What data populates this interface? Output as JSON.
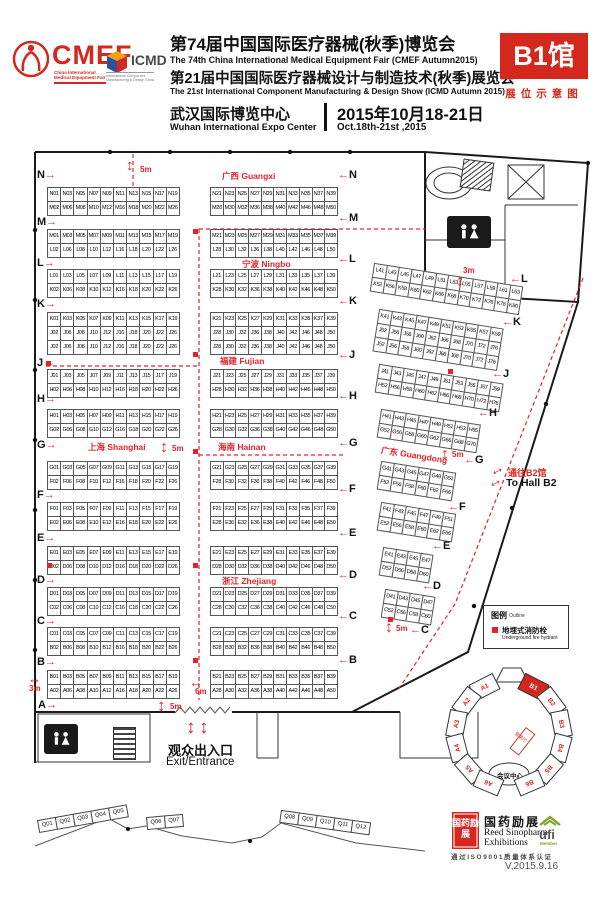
{
  "colors": {
    "brand_red": "#d4281f",
    "map_red": "#e62129",
    "ufi_green": "#7ba428"
  },
  "header": {
    "cmef_word": "CMEF",
    "cmef_sub1": "China International",
    "cmef_sub2": "Medical Equipment Fair",
    "icmd_word": "ICMD",
    "icmd_sub1": "International Component",
    "icmd_sub2": "Manufacturing & Design Show",
    "title_cn_1": "第74届中国国际医疗器械(秋季)博览会",
    "title_en_1": "The 74th China International Medical Equipment Fair (CMEF Autumn2015)",
    "title_cn_2": "第21届中国国际医疗器械设计与制造技术(秋季)展览会",
    "title_en_2": "The 21st International Component Manufacturing & Design Show (ICMD Autumn 2015)",
    "venue_cn": "武汉国际博览中心",
    "venue_en": "Wuhan International Expo Center",
    "date_cn": "2015年10月18-21日",
    "date_en": "Oct.18th-21st ,2015",
    "hall_badge": "B1馆",
    "badge_sub": "展位示意图"
  },
  "map": {
    "region_labels": [
      {
        "text": "广西 Guangxi",
        "x": 222,
        "y": 170
      },
      {
        "text": "宁波 Ningbo",
        "x": 242,
        "y": 258
      },
      {
        "text": "福建 Fujian",
        "x": 220,
        "y": 355
      },
      {
        "text": "上海 Shanghai",
        "x": 88,
        "y": 441
      },
      {
        "text": "海南 Hainan",
        "x": 218,
        "y": 441
      },
      {
        "text": "浙江 Zhejiang",
        "x": 222,
        "y": 575
      },
      {
        "text": "广东 Guangdong",
        "x": 382,
        "y": 444,
        "rot": 9
      }
    ],
    "row_letters": [
      {
        "t": "N",
        "x": 37,
        "y": 170,
        "d": "r"
      },
      {
        "t": "M",
        "x": 37,
        "y": 217,
        "d": "r"
      },
      {
        "t": "L",
        "x": 37,
        "y": 258,
        "d": "r"
      },
      {
        "t": "K",
        "x": 37,
        "y": 299,
        "d": "r"
      },
      {
        "t": "J",
        "x": 37,
        "y": 358,
        "d": "r"
      },
      {
        "t": "H",
        "x": 37,
        "y": 394,
        "d": "r"
      },
      {
        "t": "G",
        "x": 37,
        "y": 440,
        "d": "r"
      },
      {
        "t": "F",
        "x": 37,
        "y": 490,
        "d": "r"
      },
      {
        "t": "E",
        "x": 37,
        "y": 533,
        "d": "r"
      },
      {
        "t": "D",
        "x": 37,
        "y": 575,
        "d": "r"
      },
      {
        "t": "C",
        "x": 37,
        "y": 616,
        "d": "r"
      },
      {
        "t": "B",
        "x": 37,
        "y": 657,
        "d": "r"
      },
      {
        "t": "A",
        "x": 38,
        "y": 700,
        "d": "r"
      },
      {
        "t": "N",
        "x": 338,
        "y": 170,
        "d": "l"
      },
      {
        "t": "M",
        "x": 338,
        "y": 213,
        "d": "l"
      },
      {
        "t": "L",
        "x": 338,
        "y": 254,
        "d": "l"
      },
      {
        "t": "K",
        "x": 338,
        "y": 296,
        "d": "l"
      },
      {
        "t": "J",
        "x": 338,
        "y": 350,
        "d": "l"
      },
      {
        "t": "H",
        "x": 338,
        "y": 391,
        "d": "l"
      },
      {
        "t": "G",
        "x": 338,
        "y": 438,
        "d": "l"
      },
      {
        "t": "F",
        "x": 338,
        "y": 484,
        "d": "l"
      },
      {
        "t": "E",
        "x": 338,
        "y": 528,
        "d": "l"
      },
      {
        "t": "D",
        "x": 338,
        "y": 570,
        "d": "l"
      },
      {
        "t": "C",
        "x": 338,
        "y": 611,
        "d": "l"
      },
      {
        "t": "B",
        "x": 338,
        "y": 655,
        "d": "l"
      },
      {
        "t": "L",
        "x": 510,
        "y": 274,
        "d": "l"
      },
      {
        "t": "K",
        "x": 502,
        "y": 317,
        "d": "l"
      },
      {
        "t": "J",
        "x": 492,
        "y": 369,
        "d": "l"
      },
      {
        "t": "H",
        "x": 478,
        "y": 408,
        "d": "l"
      },
      {
        "t": "G",
        "x": 464,
        "y": 455,
        "d": "l"
      },
      {
        "t": "F",
        "x": 448,
        "y": 502,
        "d": "l"
      },
      {
        "t": "E",
        "x": 432,
        "y": 541,
        "d": "l"
      },
      {
        "t": "D",
        "x": 422,
        "y": 581,
        "d": "l"
      },
      {
        "t": "C",
        "x": 410,
        "y": 625,
        "d": "l"
      }
    ],
    "dims": [
      {
        "t": "5m",
        "x": 140,
        "y": 165
      },
      {
        "t": "5m",
        "x": 172,
        "y": 444
      },
      {
        "t": "5m",
        "x": 170,
        "y": 702
      },
      {
        "t": "5m",
        "x": 452,
        "y": 450
      },
      {
        "t": "5m",
        "x": 396,
        "y": 624
      },
      {
        "t": "3m",
        "x": 29,
        "y": 684
      },
      {
        "t": "6m",
        "x": 195,
        "y": 687
      },
      {
        "t": "3m",
        "x": 463,
        "y": 266
      }
    ],
    "arrows": [
      {
        "g": "↕",
        "x": 126,
        "y": 158,
        "s": 15
      },
      {
        "g": "↕",
        "x": 160,
        "y": 440,
        "s": 16
      },
      {
        "g": "↕",
        "x": 157,
        "y": 697,
        "s": 17
      },
      {
        "g": "↕",
        "x": 441,
        "y": 447,
        "s": 16
      },
      {
        "g": "↕",
        "x": 385,
        "y": 620,
        "s": 16
      },
      {
        "g": "↕",
        "x": 456,
        "y": 274,
        "s": 16
      },
      {
        "g": "↔",
        "x": 28,
        "y": 672,
        "s": 13
      },
      {
        "g": "↔",
        "x": 189,
        "y": 675,
        "s": 14
      },
      {
        "g": "↕",
        "x": 186,
        "y": 718,
        "s": 19
      },
      {
        "g": "↕",
        "x": 199,
        "y": 718,
        "s": 19
      },
      {
        "g": "↔",
        "x": 489,
        "y": 462,
        "s": 15,
        "rot": -28
      },
      {
        "g": "↔",
        "x": 487,
        "y": 474,
        "s": 15,
        "rot": -28
      }
    ],
    "hydrants": [
      [
        193,
        229
      ],
      [
        193,
        352
      ],
      [
        193,
        449
      ],
      [
        193,
        563
      ],
      [
        193,
        658
      ],
      [
        46,
        361
      ],
      [
        47,
        563
      ],
      [
        448,
        369
      ],
      [
        388,
        617
      ]
    ],
    "strips": [
      {
        "x": 48,
        "y": 188,
        "cw": 14.2,
        "rows": [
          "N01 N03 N05 N07 N09 N11 N13 N15 N17 N19",
          "M02 M06 M08 M10 M12 M16 M18 M20 M22 M26"
        ]
      },
      {
        "x": 48,
        "y": 230,
        "cw": 14.2,
        "rows": [
          "M01 M03 M05 M07 M09 M11 M13 M15 M17 M19",
          "L02 L06 L08 L10 L12 L16 L18 L20 L22 L26"
        ]
      },
      {
        "x": 48,
        "y": 270,
        "cw": 14.2,
        "rows": [
          "L01 L03 L05 L07 L09 L11 L13 L15 L17 L19",
          "K02 K06 K08 K10 K12 K16 K18 K20 K22 K26"
        ]
      },
      {
        "x": 48,
        "y": 313,
        "cw": 14.2,
        "rows": [
          "K01 K03 K05 K07 K09 K11 K13 K15 K17 K19",
          "J02 J06 J08 J10 J12 J16 J18 J20 J22 J26",
          "J02 J06 J08 J10 J12 J16 J18 J20 J22 J26"
        ]
      },
      {
        "x": 48,
        "y": 370,
        "cw": 14.2,
        "rows": [
          "J01 J03 J05 J07 J09 J11 J13 J15 J17 J19",
          "H02 H06 H08 H10 H12 H16 H18 H20 H22 H26"
        ]
      },
      {
        "x": 48,
        "y": 410,
        "cw": 14.2,
        "rows": [
          "H01 H03 H05 H07 H09 H11 H13 H15 H17 H19",
          "G02 G06 G08 G10 G12 G16 G18 G20 G22 G26"
        ]
      },
      {
        "x": 48,
        "y": 462,
        "cw": 14.2,
        "rows": [
          "G01 G03 G05 G07 G09 G11 G13 G15 G17 G19",
          "F02 F06 F08 F10 F12 F16 F18 F20 F22 F26"
        ]
      },
      {
        "x": 48,
        "y": 503,
        "cw": 14.2,
        "rows": [
          "F01 F03 F05 F07 F09 F11 F13 F15 F17 F19",
          "E02 E06 E08 E10 E12 E16 E18 E20 E22 E26"
        ]
      },
      {
        "x": 48,
        "y": 547,
        "cw": 14.2,
        "rows": [
          "E01 E03 E05 E07 E09 E11 E13 E15 E17 E19",
          "D02 D06 D08 D10 D12 D16 D18 D20 D22 D26"
        ]
      },
      {
        "x": 48,
        "y": 588,
        "cw": 14.2,
        "rows": [
          "D01 D03 D05 D07 D09 D11 D13 D15 D17 D19",
          "C02 C06 C08 C10 C12 C16 C18 C20 C22 C26"
        ]
      },
      {
        "x": 48,
        "y": 628,
        "cw": 14.2,
        "rows": [
          "C01 C03 C05 C07 C09 C11 C13 C15 C17 C19",
          "B02 B06 B08 B10 B12 B16 B18 B20 B22 B26"
        ]
      },
      {
        "x": 48,
        "y": 671,
        "cw": 14.2,
        "rows": [
          "B01 B03 B05 B07 B09 B11 B13 B15 B17 B19",
          "A02 A06 A08 A10 A12 A16 A18 A20 A22 A26"
        ]
      },
      {
        "x": 211,
        "y": 188,
        "cw": 13.7,
        "rows": [
          "N21 N23 N25 N27 N29 N31 N33 N35 N37 N39",
          "M28 M30 M32 M36 M38 M40 M42 M46 M48 M50"
        ]
      },
      {
        "x": 211,
        "y": 230,
        "cw": 13.7,
        "rows": [
          "M21 M23 M25 M27 M29 M31 M33 M35 M37 M39",
          "L28 L30 L32 L36 L38 L40 L42 L46 L48 L50"
        ]
      },
      {
        "x": 211,
        "y": 270,
        "cw": 13.7,
        "rows": [
          "L21 L23 L25 L27 L29 L31 L33 L35 L37 L39",
          "K28 K30 K32 K36 K38 K40 K42 K46 K48 K50"
        ]
      },
      {
        "x": 211,
        "y": 313,
        "cw": 13.7,
        "rows": [
          "K21 K23 K25 K27 K29 K31 K33 K35 K37 K39",
          "J28 J30 J32 J36 J38 J40 J42 J46 J48 J50",
          "J28 J30 J32 J36 J38 J40 J42 J46 J48 J50"
        ]
      },
      {
        "x": 211,
        "y": 370,
        "cw": 13.7,
        "rows": [
          "J21 J23 J25 J27 J29 J31 J33 J35 J37 J39",
          "H28 H30 H32 H36 H38 H40 H42 H46 H48 H50"
        ]
      },
      {
        "x": 211,
        "y": 410,
        "cw": 13.7,
        "rows": [
          "H21 H23 H25 H27 H29 H31 H33 H35 H37 H39",
          "G28 G30 G32 G36 G38 G40 G42 G46 G48 G50"
        ]
      },
      {
        "x": 211,
        "y": 462,
        "cw": 13.7,
        "rows": [
          "G21 G23 G25 G27 G29 G31 G33 G35 G37 G39",
          "F28 F30 F32 F36 F38 F40 F42 F46 F48 F50"
        ]
      },
      {
        "x": 211,
        "y": 503,
        "cw": 13.7,
        "rows": [
          "F21 F23 F25 F27 F29 F31 F33 F35 F37 F39",
          "E28 E30 E32 E36 E38 E40 E42 E46 E48 E50"
        ]
      },
      {
        "x": 211,
        "y": 547,
        "cw": 13.7,
        "rows": [
          "E21 E23 E25 E27 E29 E31 E33 E35 E37 E39",
          "D28 D30 D32 D36 D38 D40 D42 D46 D48 D50"
        ]
      },
      {
        "x": 211,
        "y": 588,
        "cw": 13.7,
        "rows": [
          "D21 D23 D25 D27 D29 D31 D33 D35 D37 D39",
          "C28 C30 C32 C36 C38 C40 C42 C46 C48 C50"
        ]
      },
      {
        "x": 211,
        "y": 628,
        "cw": 13.7,
        "rows": [
          "C21 C23 C25 C27 C29 C31 C33 C35 C37 C39",
          "B28 B30 B32 B36 B38 B40 B42 B46 B48 B50"
        ]
      },
      {
        "x": 211,
        "y": 671,
        "cw": 13.7,
        "rows": [
          "B21 B23 B25 B27 B29 B31 B33 B35 B37 B39",
          "A28 A30 A32 A36 A38 A40 A42 A46 A48 A50"
        ]
      },
      {
        "x": 375,
        "y": 264,
        "cw": 13.5,
        "rot": 9,
        "rows": [
          "L41 L43 L45 L47 L49 L51 L53 L55 L57 L59 L61 L63",
          "K52 K56 K58 K60 K62 K66 K68 K70 K72 K76 K78 K80"
        ]
      },
      {
        "x": 380,
        "y": 310,
        "cw": 13.5,
        "rot": 9,
        "rows": [
          "K41 K43 K45 K47 K49 K51 K53 K55 K57 K59",
          "J52 J56 J58 J60 J62 J66 J68 J70 J72 J76",
          "J52 J56 J58 J60 J62 J66 J68 J70 J72 J76"
        ]
      },
      {
        "x": 380,
        "y": 365,
        "cw": 13.5,
        "rot": 9,
        "rows": [
          "J41 J43 J45 J47 J49 J51 J53 J55 J57 J59",
          "H52 H56 H58 H60 H62 H66 H68 H70 H72 H76"
        ]
      },
      {
        "x": 382,
        "y": 410,
        "cw": 13.5,
        "rot": 9,
        "rows": [
          "H41 H43 H45 H47 H49 H51 H53 H55",
          "G52 G56 G58 G60 G62 G66 G68 G70"
        ]
      },
      {
        "x": 382,
        "y": 462,
        "cw": 13.5,
        "rot": 9,
        "rows": [
          "G41 G43 G45 G47 G49 G51",
          "F52 F56 F58 F60 F62 F66"
        ]
      },
      {
        "x": 382,
        "y": 503,
        "cw": 13.5,
        "rot": 9,
        "rows": [
          "F41 F43 F45 F47 F49 F51",
          "E52 E56 E58 E60 E62 E66"
        ]
      },
      {
        "x": 384,
        "y": 548,
        "cw": 13.5,
        "rot": 9,
        "rows": [
          "E41 E43 E45 E47",
          "D52 D56 D58 D60"
        ]
      },
      {
        "x": 386,
        "y": 590,
        "cw": 13.5,
        "rot": 9,
        "rows": [
          "D41 D43 D45 D47",
          "C52 C56 C58 C60"
        ]
      }
    ],
    "exit": {
      "cn": "观众出入口",
      "en": "Exit/Entrance"
    },
    "to_b2": {
      "cn": "通往B2馆",
      "en": "To Hall B2"
    },
    "legend": {
      "title_cn": "图例",
      "title_en": "Outline",
      "item_cn": "地埋式消防栓",
      "item_en": "Underground fire hydrant"
    },
    "minimap": {
      "halls": [
        {
          "label": "A1",
          "angle": 117
        },
        {
          "label": "A2",
          "angle": 143
        },
        {
          "label": "A3",
          "angle": 169
        },
        {
          "label": "A4",
          "angle": 195
        },
        {
          "label": "A5",
          "angle": 221
        },
        {
          "label": "A6",
          "angle": 247
        },
        {
          "label": "B1",
          "angle": 63,
          "active": true
        },
        {
          "label": "B2",
          "angle": 37
        },
        {
          "label": "B3",
          "angle": 11
        },
        {
          "label": "B4",
          "angle": 345
        },
        {
          "label": "B5",
          "angle": 319
        },
        {
          "label": "B6",
          "angle": 293
        }
      ],
      "center_label": "会议中心",
      "red_label": "登录厅"
    },
    "q_groups": [
      {
        "x": 38,
        "y": 820,
        "rot": -10,
        "labels": [
          "Q01",
          "Q02",
          "Q03",
          "Q04",
          "Q05"
        ]
      },
      {
        "x": 147,
        "y": 817,
        "rot": -5,
        "labels": [
          "Q06",
          "Q07"
        ]
      },
      {
        "x": 282,
        "y": 810,
        "rot": 8,
        "labels": [
          "Q08",
          "Q09",
          "Q10",
          "Q11",
          "Q12"
        ]
      }
    ]
  },
  "footer": {
    "seal": "国药励展",
    "sinopharm_cn": "国药励展",
    "sinopharm_en1": "Reed Sinopharm",
    "sinopharm_en2": "Exhibitions",
    "ufi": "ufi",
    "ufi_sub": "Member",
    "iso": "通过ISO9001质量体系认证",
    "version": "V,2015.9.16"
  }
}
